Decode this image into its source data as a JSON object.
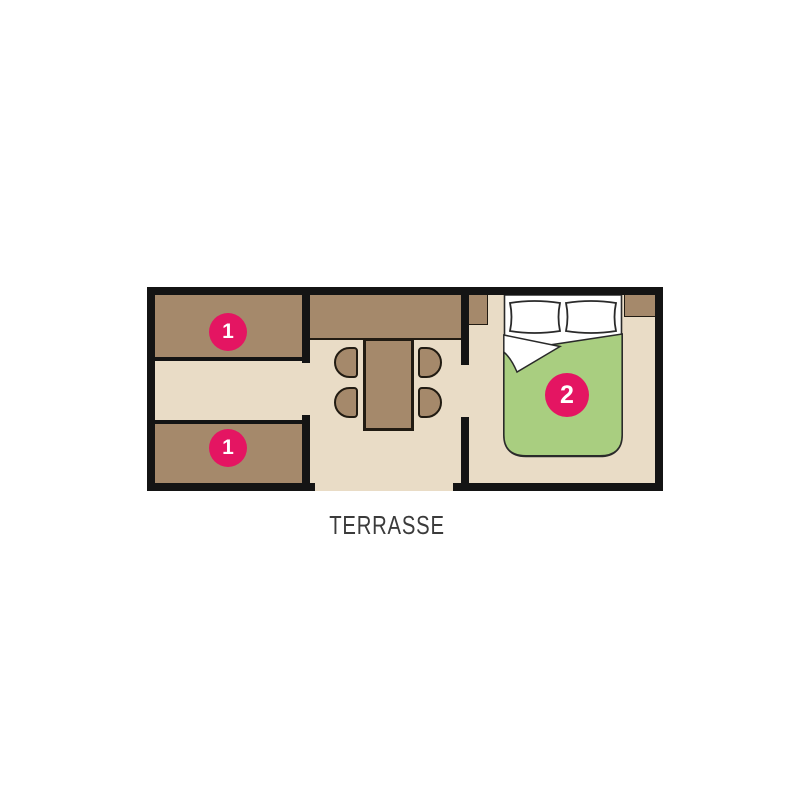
{
  "floorplan": {
    "terrace_label": "TERRASSE",
    "colors": {
      "wall": "#141414",
      "floor": "#e9dcc6",
      "furniture_brown": "#a5896b",
      "outline_dark": "#211b12",
      "blanket_green": "#a9ce80",
      "pillow_white": "#ffffff",
      "badge_pink": "#e41562",
      "text": "#3b3b3b"
    },
    "rooms": {
      "kids_room": {
        "beds": [
          {
            "badge": "1",
            "position": "top"
          },
          {
            "badge": "1",
            "position": "bottom"
          }
        ]
      },
      "living_kitchen": {
        "furniture": [
          "kitchen-counter",
          "dining-table",
          "chair",
          "chair",
          "chair",
          "chair"
        ],
        "openings": [
          "terrace-door"
        ]
      },
      "bedroom": {
        "badge": "2",
        "furniture": [
          "double-bed",
          "cabinet",
          "cabinet"
        ]
      }
    }
  }
}
